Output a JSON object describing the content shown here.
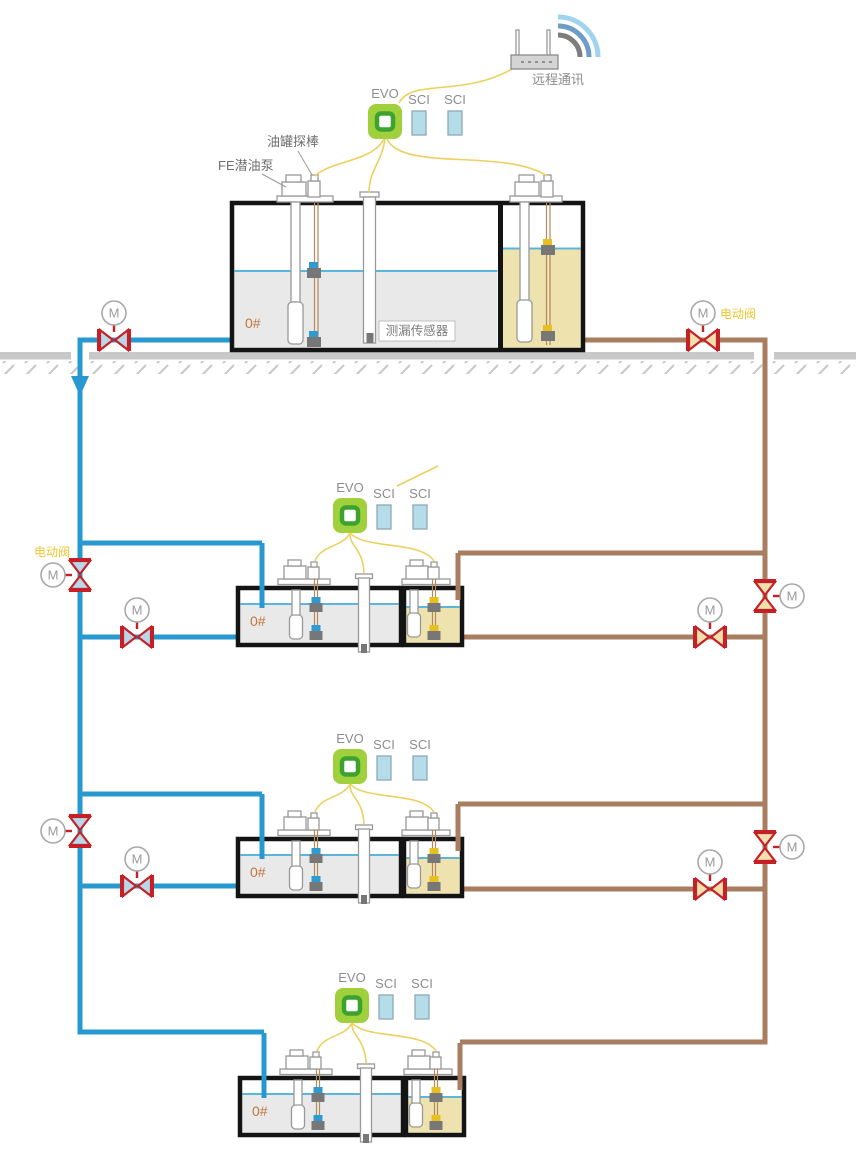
{
  "labels": {
    "remote_comm": "远程通讯",
    "evo": "EVO",
    "sci": "SCI",
    "tank_grade": "0#",
    "leak_sensor": "测漏传感器",
    "submersible_pump": "FE潜油泵",
    "tank_probe": "油罐探棒",
    "electric_valve": "电动阀",
    "valve_motor": "M"
  },
  "colors": {
    "pipe_blue": "#2898d0",
    "pipe_brown": "#a87d60",
    "wire_yellow": "#edd05e",
    "valve_red": "#c42127",
    "valve_fill_blue": "#b9d7e8",
    "valve_fill_tan": "#f2dfae",
    "evo_green": "#a0d03c",
    "evo_ring": "#3da32f",
    "sci_blue": "#b5dde9",
    "tank_border": "#141414",
    "tank_fill_gray": "#e9e9e9",
    "tank_fill_yellow": "#eee2ae",
    "waterline": "#5ab6dc",
    "ground_gray": "#c8c8c8",
    "label_gray": "#8c8c8c",
    "label_orange": "#c0763e",
    "label_yellow": "#edc52c",
    "float_blue": "#2e9bd0",
    "float_yellow": "#e7c01f",
    "probe_wire": "#b28a5e",
    "wifi_light": "#9fd3ee",
    "wifi_mid": "#6d9cc6",
    "wifi_dark": "#7d7d7d"
  }
}
